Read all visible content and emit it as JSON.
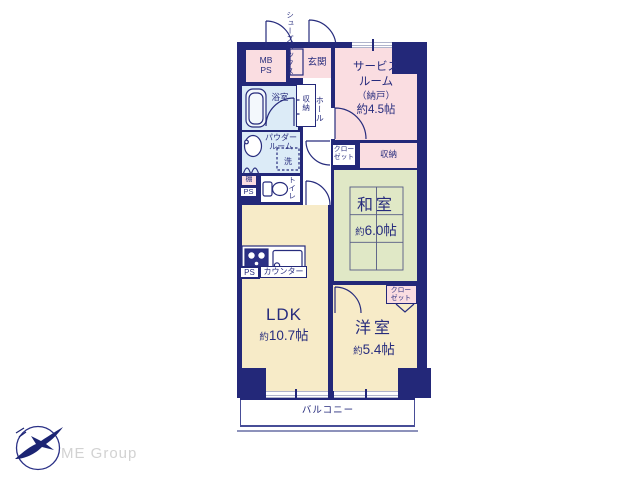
{
  "page": {
    "background": "#ffffff"
  },
  "palette": {
    "wall_navy": "#232879",
    "text_navy": "#272c7d",
    "room_pink": "#fadde1",
    "room_cream": "#f7ebc8",
    "room_green": "#e0e8c6",
    "room_blue": "#dcebf7",
    "window_line_gray": "#b0b4cc",
    "logo_navy": "#1b2473",
    "logo_text_gray": "#d2d2d2"
  },
  "floorplan": {
    "shoes_box": {
      "col_right": "シューズ",
      "col_left": "ボックス"
    },
    "mb_ps": {
      "line1": "MB",
      "line2": "PS"
    },
    "entrance": {
      "label": "玄関"
    },
    "service_room": {
      "line1": "サービス",
      "line2": "ルーム",
      "line3": "（納戸）",
      "line4": "約4.5帖"
    },
    "bathroom": {
      "label": "浴室"
    },
    "hall_closet": {
      "label": "収納"
    },
    "hall": {
      "label": "ホール"
    },
    "powder_room": {
      "line1": "パウダー",
      "line2": "ルーム"
    },
    "washer": {
      "label": "洗"
    },
    "shelf": {
      "label": "棚"
    },
    "ps_shaft_upper": {
      "label": "PS"
    },
    "toilet": {
      "label": "トイレ"
    },
    "hall_end_closet": {
      "line1": "クロー",
      "line2": "ゼット"
    },
    "storage": {
      "label": "収納"
    },
    "japanese_room": {
      "name": "和室",
      "size_prefix": "約",
      "size_value": "6.0帖"
    },
    "ldk": {
      "name": "LDK",
      "size_prefix": "約",
      "size_value": "10.7帖"
    },
    "kitchen": {
      "counter_label": "カウンター",
      "ps_label": "PS"
    },
    "western_room": {
      "name": "洋室",
      "size_prefix": "約",
      "size_value": "5.4帖"
    },
    "western_closet": {
      "line1": "クロー",
      "line2": "ゼット"
    },
    "balcony": {
      "label": "バルコニー"
    }
  },
  "branding": {
    "logo_text": "ME Group"
  }
}
